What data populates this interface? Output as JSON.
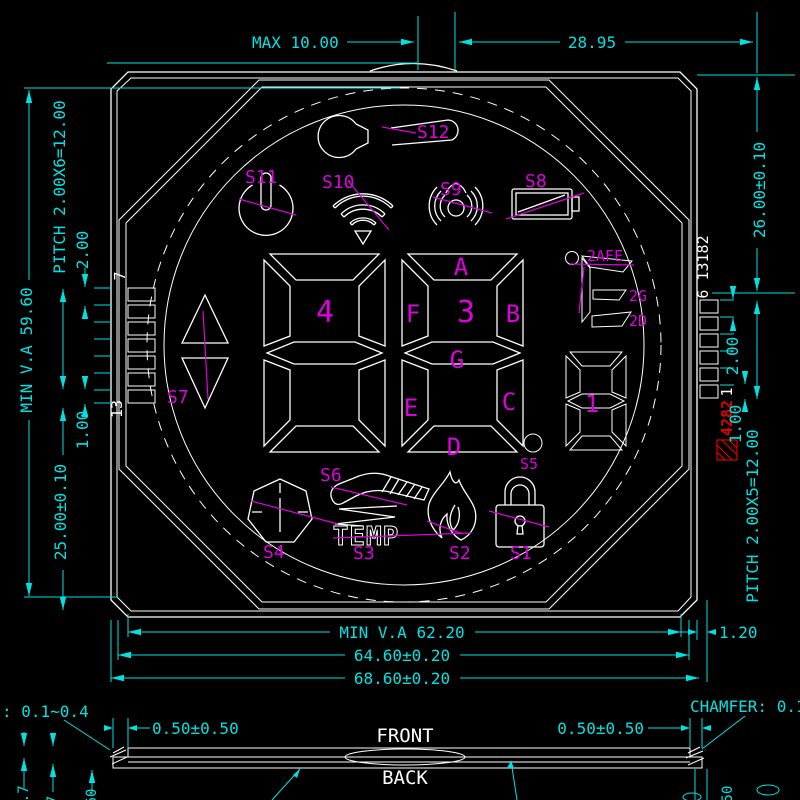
{
  "colors": {
    "dimension": "#00E2E2",
    "outline": "#FFFFFF",
    "label": "#DE00DE",
    "stamp": "#E00000",
    "background": "#000000"
  },
  "dims": {
    "max": "MAX 10.00",
    "top_width": "28.95",
    "r_height": "26.00±0.10",
    "r_step": "2.00",
    "r_gap": "1.00",
    "r_pitch": "PITCH 2.00X5=12.00",
    "r_offset": "1.20",
    "l_va": "MIN V.A 59.60",
    "l_pitch": "PITCH 2.00X6=12.00",
    "l_step": "2.00",
    "l_gap": "1.00",
    "l_height": "25.00±0.10",
    "b_va": "MIN V.A 62.20",
    "b_mid": "64.60±0.20",
    "b_outer": "68.60±0.20"
  },
  "side": {
    "front": "FRONT",
    "back": "BACK",
    "l_tol": "0.50±0.50",
    "r_tol": "0.50±0.50",
    "l_chamfer": ": 0.1~0.4",
    "r_chamfer": "CHAMFER: 0.1~",
    "cut_a": "0.7",
    "cut_b": "7",
    "cut_c": "60",
    "cut_d": "50"
  },
  "pins": {
    "l_first": "7",
    "l_last": "13",
    "r_top": "6 13182",
    "r_pin": "1",
    "stamp": "4282"
  },
  "display": {
    "digit_left": "4",
    "digit_right": "3",
    "digit_small": "1",
    "seg_a": "A",
    "seg_b": "B",
    "seg_c": "C",
    "seg_d": "D",
    "seg_e": "E",
    "seg_f": "F",
    "seg_g": "G",
    "unit_top": "2AFE",
    "unit_mid": "2G",
    "unit_bot": "2D",
    "temp": "TEMP"
  },
  "labels": {
    "s1": "S1",
    "s2": "S2",
    "s3": "S3",
    "s4": "S4",
    "s5": "S5",
    "s6": "S6",
    "s7": "S7",
    "s8": "S8",
    "s9": "S9",
    "s10": "S10",
    "s11": "S11",
    "s12": "S12"
  }
}
